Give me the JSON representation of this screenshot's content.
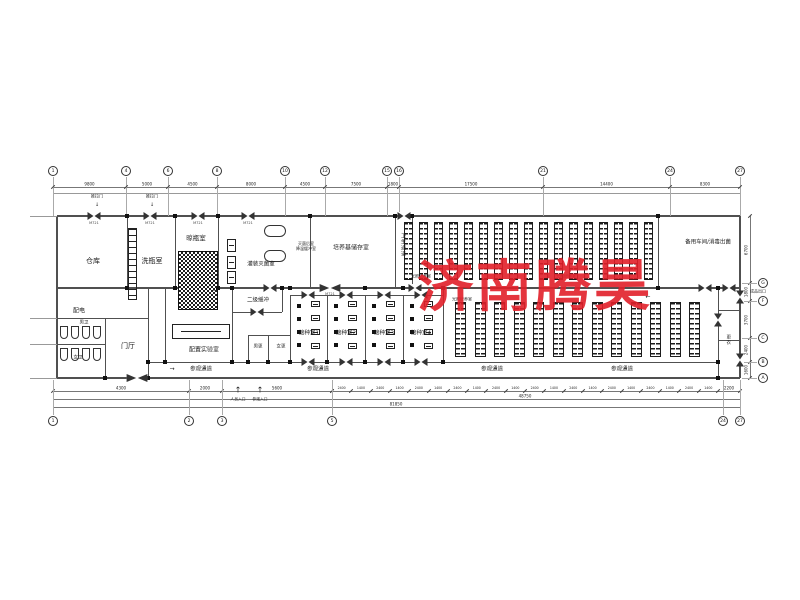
{
  "watermark": {
    "text": "济南腾昊",
    "color": "#e2202a"
  },
  "rooms": {
    "cangku": "仓库",
    "xiping": "洗瓶室",
    "liangping": "晾瓶室",
    "guanzhuang": "灌装灭菌室",
    "miejun_note": "灭菌后室\n降温缓冲室",
    "peiyangji": "培养基储存室",
    "weisheng": "卫生通道",
    "beiyong": "备用车间/消毒出菌",
    "guangzhao": "光照培养室",
    "peidian": "配电",
    "nanwei": "男卫",
    "nvwei": "女卫",
    "menting": "门厅",
    "peizhi_lab": "配置实验室",
    "erji": "二级缓冲",
    "nangeng": "男更",
    "nvgeng": "女更",
    "jiezhong1": "接种室1",
    "jiezhong2": "接种室2",
    "jiezhong3": "接种室3",
    "jiezhong4": "接种室4",
    "canguan": "参观通道",
    "gengyi": "更衣",
    "chukou": "成品出口",
    "renyuan_rukou": "人员入口",
    "canguan_rukou": "参观入口",
    "tuilamen": "推拉门",
    "door_tag": "M721"
  },
  "axis": {
    "top_labels": [
      "1",
      "4",
      "6",
      "8",
      "10",
      "12",
      "15",
      "16",
      "21",
      "24",
      "27"
    ],
    "top_dims": [
      "9800",
      "5000",
      "4500",
      "8000",
      "4500",
      "7500",
      "1800",
      "17500",
      "14400",
      "8300"
    ],
    "bottom_labels": [
      "1",
      "2",
      "3",
      "5",
      "24",
      "27"
    ],
    "bottom_dims_left": [
      "4300",
      "2000",
      "5600"
    ],
    "bottom_dims_repeat": [
      "2400",
      "1400"
    ],
    "bottom_dims_right": "2200",
    "bottom_total_mid": "48750",
    "bottom_total_full": "81850",
    "right_labels": [
      "G",
      "F",
      "C",
      "B",
      "A"
    ],
    "right_dims": [
      "6700",
      "1800",
      "3700",
      "2400",
      "1600"
    ]
  }
}
